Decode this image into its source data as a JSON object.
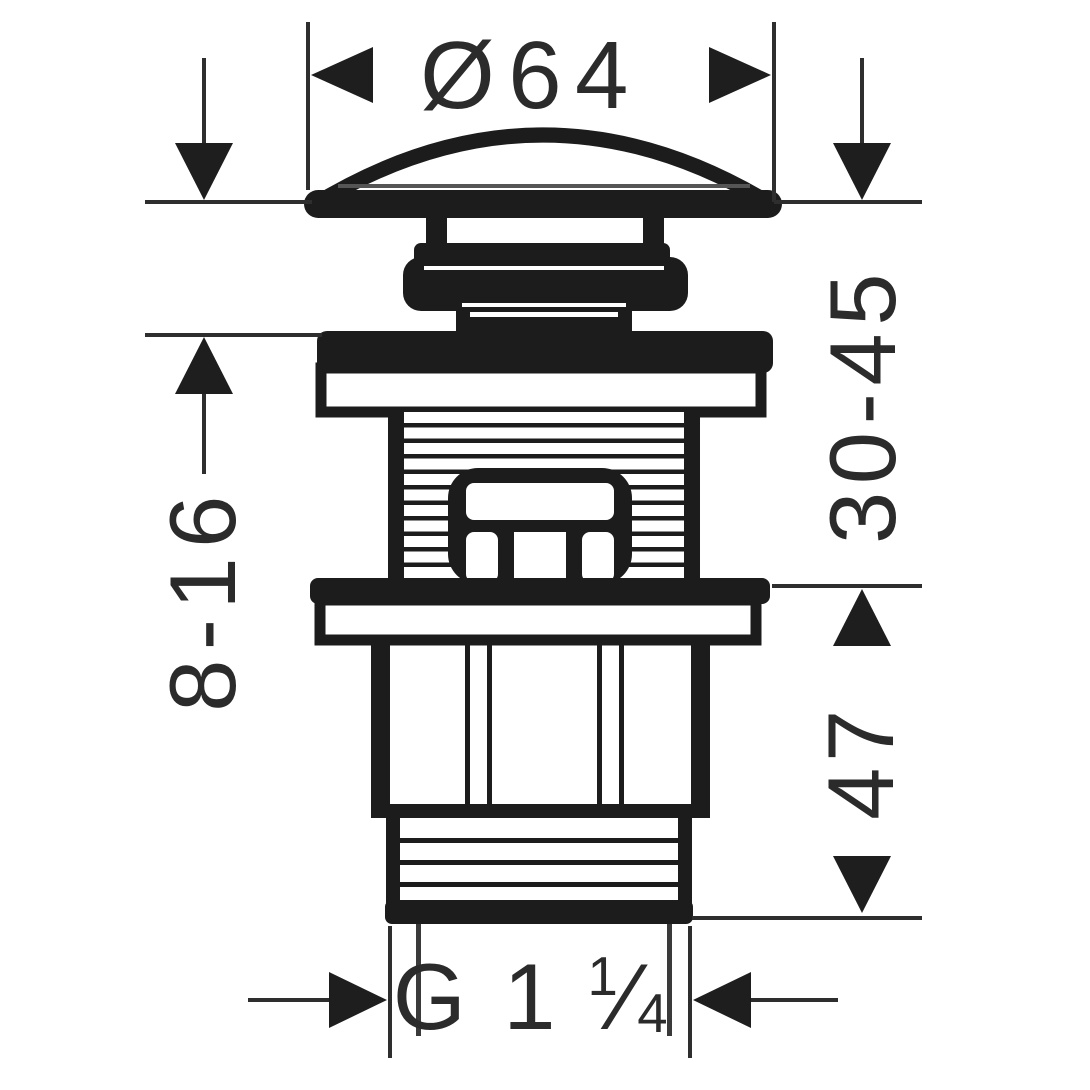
{
  "diagram": {
    "background_color": "#ffffff",
    "ink_color": "#1c1c1c",
    "dimension_color": "#2e2e2e",
    "dimensions": {
      "cap_diameter": "Ø64",
      "clamp_thickness_range": "8-16",
      "install_depth_range": "30-45",
      "lower_height": "47",
      "outlet_thread_prefix": "G 1",
      "outlet_thread_frac_numerator": "1",
      "outlet_thread_frac_slash": "⁄",
      "outlet_thread_frac_denominator": "4"
    }
  }
}
